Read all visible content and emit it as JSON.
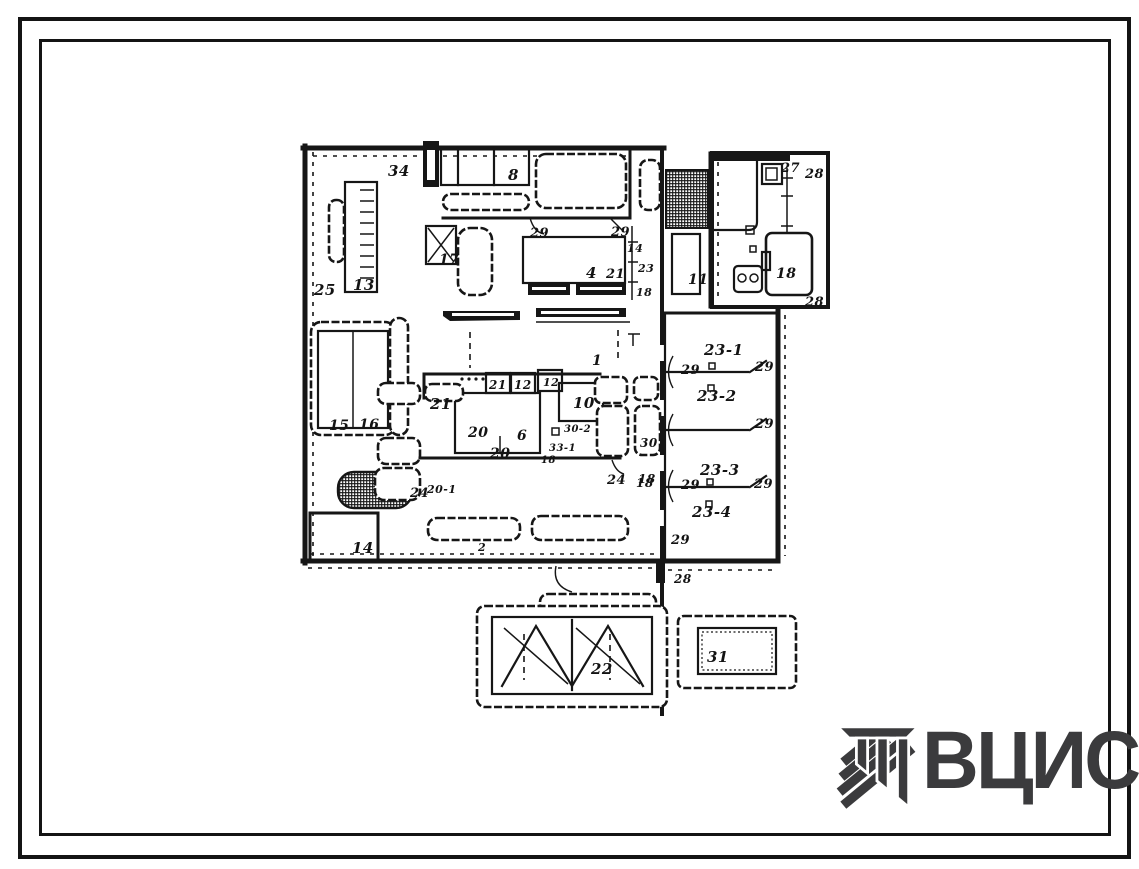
{
  "page": {
    "background": "#ffffff",
    "ink": "#161616"
  },
  "logo": {
    "text": "ВЦИС",
    "color": "#3b3b3d"
  },
  "plan": {
    "labels": [
      {
        "t": "34",
        "x": 388,
        "y": 176,
        "s": 15
      },
      {
        "t": "8",
        "x": 508,
        "y": 180,
        "s": 15
      },
      {
        "t": "25",
        "x": 314,
        "y": 295,
        "s": 15
      },
      {
        "t": "13",
        "x": 353,
        "y": 290,
        "s": 15
      },
      {
        "t": "17",
        "x": 439,
        "y": 264,
        "s": 14
      },
      {
        "t": "29",
        "x": 530,
        "y": 237,
        "s": 13
      },
      {
        "t": "29",
        "x": 611,
        "y": 236,
        "s": 13
      },
      {
        "t": "14",
        "x": 627,
        "y": 252,
        "s": 11
      },
      {
        "t": "4",
        "x": 586,
        "y": 278,
        "s": 15
      },
      {
        "t": "21",
        "x": 606,
        "y": 278,
        "s": 13
      },
      {
        "t": "23",
        "x": 638,
        "y": 272,
        "s": 11
      },
      {
        "t": "18",
        "x": 636,
        "y": 296,
        "s": 11
      },
      {
        "t": "11",
        "x": 688,
        "y": 284,
        "s": 14
      },
      {
        "t": "27",
        "x": 781,
        "y": 172,
        "s": 13
      },
      {
        "t": "28",
        "x": 805,
        "y": 178,
        "s": 13
      },
      {
        "t": "18",
        "x": 776,
        "y": 278,
        "s": 14
      },
      {
        "t": "28",
        "x": 805,
        "y": 306,
        "s": 13
      },
      {
        "t": "1",
        "x": 592,
        "y": 365,
        "s": 14
      },
      {
        "t": "29",
        "x": 681,
        "y": 374,
        "s": 13
      },
      {
        "t": "29",
        "x": 755,
        "y": 371,
        "s": 13
      },
      {
        "t": "23-1",
        "x": 704,
        "y": 355,
        "s": 15
      },
      {
        "t": "23-2",
        "x": 697,
        "y": 401,
        "s": 15
      },
      {
        "t": "29",
        "x": 755,
        "y": 428,
        "s": 13
      },
      {
        "t": "30",
        "x": 640,
        "y": 447,
        "s": 12
      },
      {
        "t": "18",
        "x": 636,
        "y": 487,
        "s": 12
      },
      {
        "t": "23-3",
        "x": 700,
        "y": 475,
        "s": 15
      },
      {
        "t": "29",
        "x": 681,
        "y": 489,
        "s": 13
      },
      {
        "t": "29",
        "x": 754,
        "y": 488,
        "s": 13
      },
      {
        "t": "23-4",
        "x": 692,
        "y": 517,
        "s": 15
      },
      {
        "t": "29",
        "x": 671,
        "y": 544,
        "s": 13
      },
      {
        "t": "28",
        "x": 674,
        "y": 583,
        "s": 12
      },
      {
        "t": "21",
        "x": 430,
        "y": 409,
        "s": 15
      },
      {
        "t": "21",
        "x": 489,
        "y": 389,
        "s": 12
      },
      {
        "t": "12",
        "x": 514,
        "y": 389,
        "s": 12
      },
      {
        "t": "12",
        "x": 543,
        "y": 386,
        "s": 11
      },
      {
        "t": "10",
        "x": 573,
        "y": 408,
        "s": 15
      },
      {
        "t": "20",
        "x": 468,
        "y": 437,
        "s": 14
      },
      {
        "t": "6",
        "x": 517,
        "y": 440,
        "s": 14
      },
      {
        "t": "30-2",
        "x": 564,
        "y": 432,
        "s": 10
      },
      {
        "t": "33-1",
        "x": 549,
        "y": 451,
        "s": 10
      },
      {
        "t": "18",
        "x": 541,
        "y": 463,
        "s": 10
      },
      {
        "t": "20",
        "x": 490,
        "y": 458,
        "s": 14
      },
      {
        "t": "24",
        "x": 607,
        "y": 484,
        "s": 13
      },
      {
        "t": "18",
        "x": 638,
        "y": 483,
        "s": 12
      },
      {
        "t": "24",
        "x": 410,
        "y": 497,
        "s": 13
      },
      {
        "t": "20-1",
        "x": 427,
        "y": 493,
        "s": 11
      },
      {
        "t": "15",
        "x": 329,
        "y": 430,
        "s": 14
      },
      {
        "t": "16",
        "x": 359,
        "y": 429,
        "s": 14
      },
      {
        "t": "14",
        "x": 352,
        "y": 553,
        "s": 15
      },
      {
        "t": "2",
        "x": 478,
        "y": 551,
        "s": 11
      },
      {
        "t": "22",
        "x": 591,
        "y": 674,
        "s": 15
      },
      {
        "t": "31",
        "x": 707,
        "y": 662,
        "s": 15
      }
    ]
  }
}
